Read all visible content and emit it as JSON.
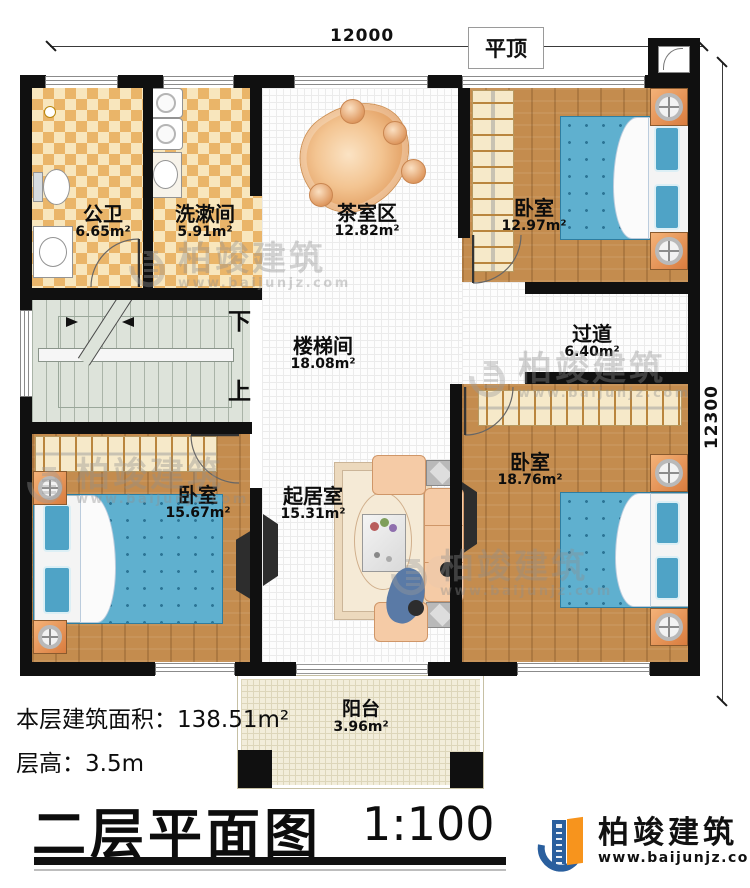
{
  "dimensions": {
    "top": "12000",
    "right": "12300"
  },
  "roof_label": "平顶",
  "stairs": {
    "down": "下",
    "up": "上"
  },
  "rooms": [
    {
      "name": "公卫",
      "area": "6.65m²"
    },
    {
      "name": "洗漱间",
      "area": "5.91m²"
    },
    {
      "name": "茶室区",
      "area": "12.82m²"
    },
    {
      "name": "卧室",
      "area": "12.97m²"
    },
    {
      "name": "楼梯间",
      "area": "18.08m²"
    },
    {
      "name": "过道",
      "area": "6.40m²"
    },
    {
      "name": "卧室",
      "area": "15.67m²"
    },
    {
      "name": "起居室",
      "area": "15.31m²"
    },
    {
      "name": "卧室",
      "area": "18.76m²"
    },
    {
      "name": "阳台",
      "area": "3.96m²"
    }
  ],
  "info": {
    "floor_area": "本层建筑面积：138.51m²",
    "floor_height": "层高：3.5m"
  },
  "title": {
    "text": "二层平面图",
    "scale": "1:100"
  },
  "brand": {
    "name": "柏竣建筑",
    "website": "www.baijunjz.com"
  },
  "watermark": {
    "name": "柏竣建筑",
    "website": "www.baijunjz.com"
  },
  "colors": {
    "wall": "#101010",
    "wood_floor": "#c48c4e",
    "tile_floor": "#f8e6bd",
    "stair_floor": "#dde3da",
    "bed": "#5fb0cf",
    "brand_blue": "#2a5f9e",
    "brand_orange": "#f7941d"
  }
}
